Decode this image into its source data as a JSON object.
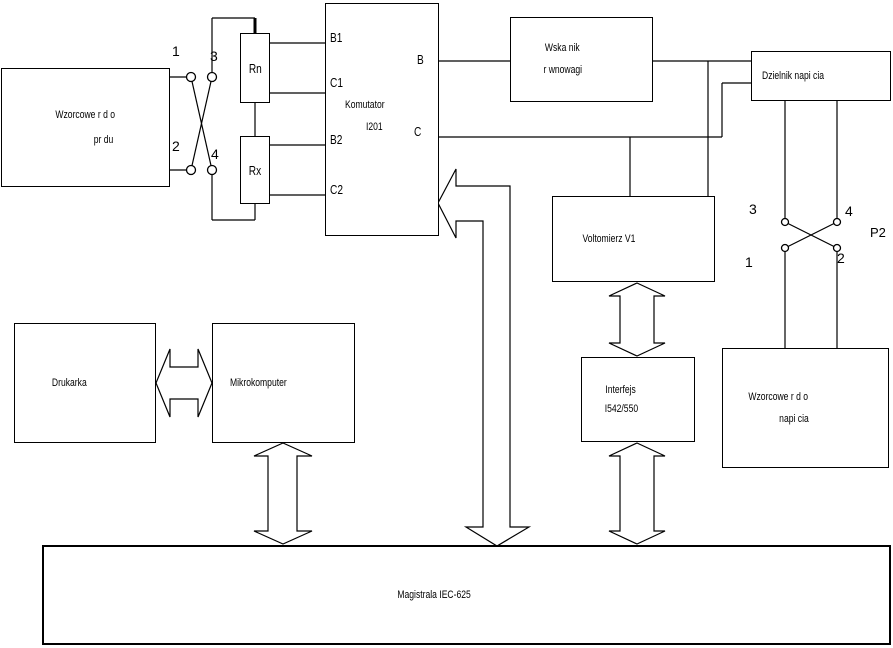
{
  "labels": {
    "current_source_1": "Wzorcowe r d o",
    "current_source_2": "pr du",
    "rn": "Rn",
    "rx": "Rx",
    "komutator_title": "Komutator",
    "komutator_model": "I201",
    "term_b1": "B1",
    "term_c1": "C1",
    "term_b2": "B2",
    "term_c2": "C2",
    "term_b": "B",
    "term_c": "C",
    "balance_1": "Wska nik",
    "balance_2": "r wnowagi",
    "divider": "Dzielnik napi cia",
    "voltmeter": "Voltomierz V1",
    "voltage_source_1": "Wzorcowe r d o",
    "voltage_source_2": "napi cia",
    "interface_1": "Interfejs",
    "interface_2": "I542/550",
    "printer": "Drukarka",
    "microcomputer": "Mikrokomputer",
    "bus": "Magistrala IEC-625",
    "p1_c1": "1",
    "p1_c2": "2",
    "p1_c3": "3",
    "p1_c4": "4",
    "p2_c1": "1",
    "p2_c2": "2",
    "p2_c3": "3",
    "p2_c4": "4",
    "p2_label": "P2"
  },
  "colors": {
    "line": "#000000",
    "background": "#ffffff"
  }
}
